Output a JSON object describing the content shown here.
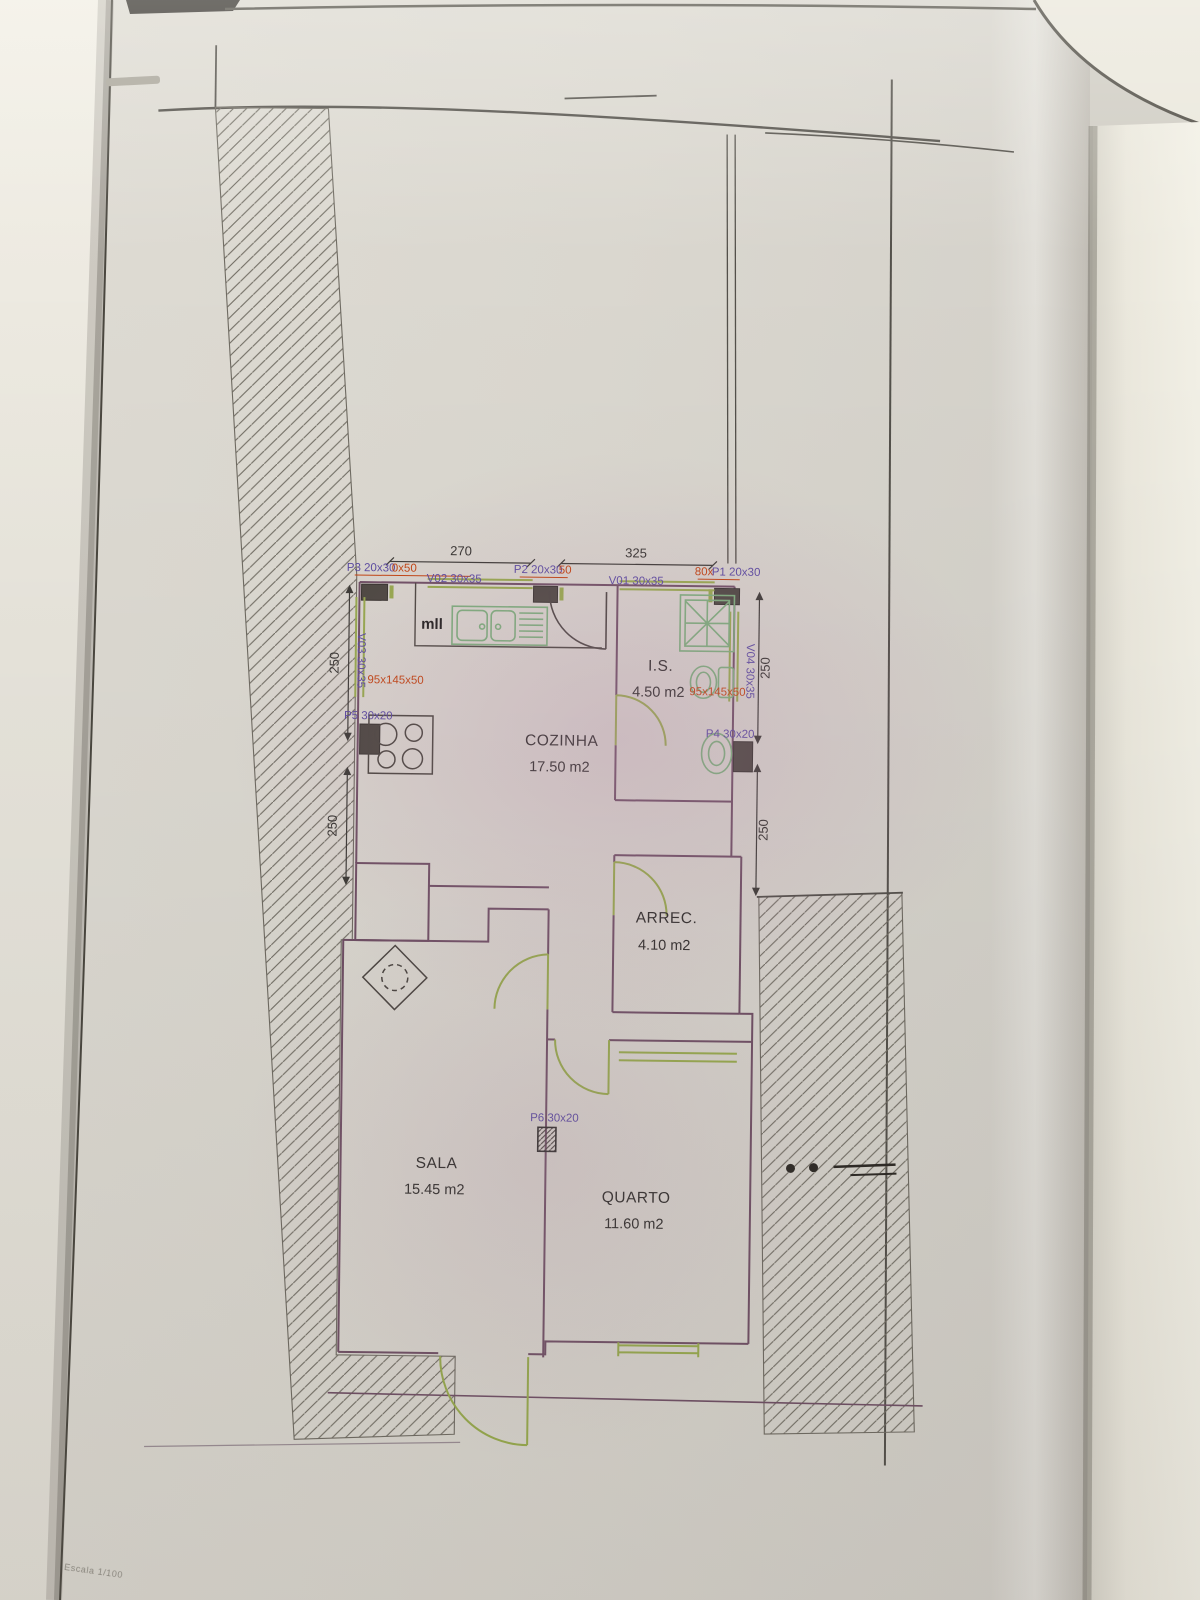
{
  "rooms": [
    {
      "name": "COZINHA",
      "area": "17.50 m2"
    },
    {
      "name": "I.S.",
      "area": "4.50 m2"
    },
    {
      "name": "ARREC.",
      "area": "4.10 m2"
    },
    {
      "name": "SALA",
      "area": "15.45 m2"
    },
    {
      "name": "QUARTO",
      "area": "11.60 m2"
    }
  ],
  "labels": {
    "p3": "P3 20x30",
    "p3_red": "0x50",
    "v02": "V02 30x35",
    "p2": "P2 20x30",
    "p2_red": "50",
    "v01": "V01 30x35",
    "p1_red": "80x",
    "p1": "P1 20x30",
    "v03": "V03 30x35",
    "v04": "V04 30x35",
    "p5": "P5 30x20",
    "p4": "P4 30x20",
    "p6": "P6 30x20",
    "left_red": "95x145x50",
    "right_red": "95x145x50",
    "kitchen_appliance": "mll"
  },
  "dimensions": {
    "top_left": "270",
    "top_right": "325",
    "left_upper": "250",
    "left_lower": "250",
    "right_upper": "250",
    "right_lower": "250"
  },
  "footer": {
    "scale_note": "Escala 1/100"
  },
  "colors": {
    "wall": "#6f4f64",
    "door_window": "#97ab4c",
    "fixture": "#7cb07c",
    "label_blue": "#5a4aa2",
    "annotation_red": "#c4430f",
    "text_black": "#2c2c28",
    "site_line": "#53504a",
    "paper": "#d8d4cc"
  }
}
